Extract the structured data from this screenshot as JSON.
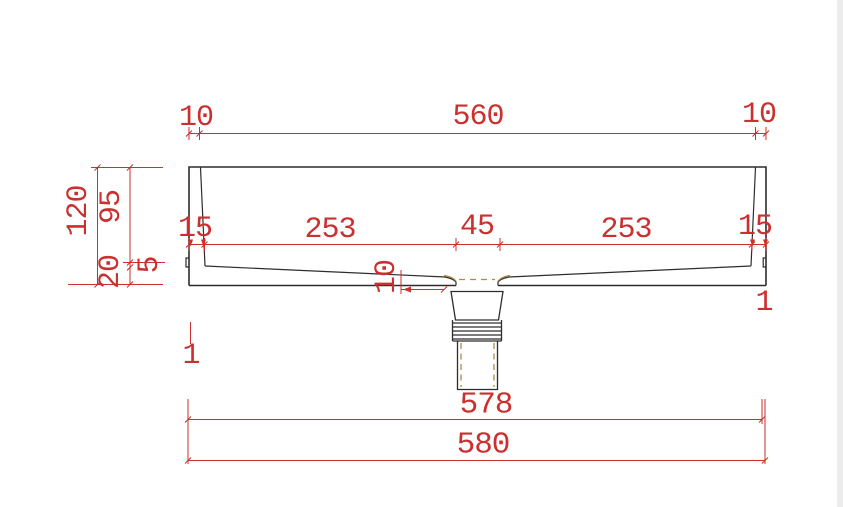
{
  "drawing": {
    "kind": "basin-section-technical-drawing"
  },
  "colors": {
    "dimension": "#cb2f2f",
    "outline": "#2d2d2d",
    "hidden": "#ad8a48",
    "background": "#ffffff"
  },
  "labels": {
    "top_left": "10",
    "top_center": "560",
    "top_right": "10",
    "height_total": "120",
    "depth_inner": "95",
    "base_height": "20",
    "rim_step": "5",
    "wall_left": "15",
    "floor_left": "253",
    "drain_width": "45",
    "floor_right": "253",
    "wall_right": "15",
    "floor_thickness": "10",
    "width_inner": "578",
    "width_outer": "580",
    "edge_left": "1",
    "edge_right": "1"
  }
}
